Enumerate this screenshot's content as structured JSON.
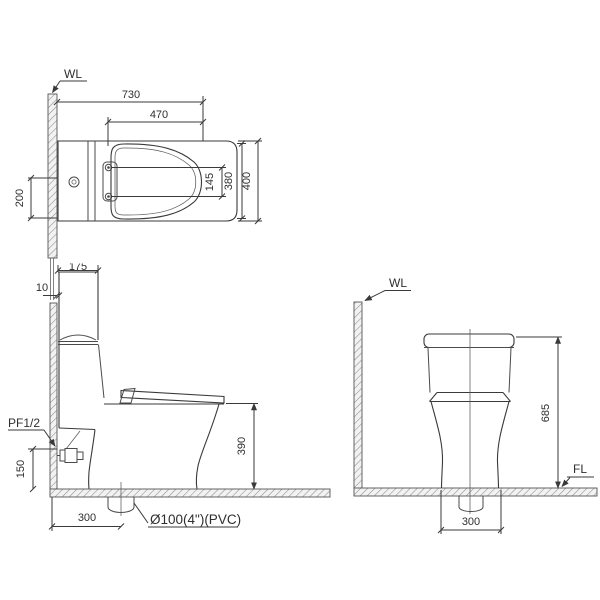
{
  "plan_view": {
    "wall_label": "WL",
    "dims": {
      "total_depth": "730",
      "seat_length": "470",
      "bolt_spacing": "145",
      "body_width": "380",
      "overall_width": "400",
      "supply_offset": "200"
    }
  },
  "side_view": {
    "supply_label": "PF1/2",
    "outlet_label": "Ø100(4\")(PVC)",
    "dims": {
      "tank_depth": "175",
      "wall_gap": "10",
      "supply_height": "150",
      "rough_in": "300",
      "seat_height": "390"
    }
  },
  "rear_view": {
    "wall_label": "WL",
    "floor_label": "FL",
    "dims": {
      "overall_height": "685",
      "base_width": "300"
    }
  }
}
